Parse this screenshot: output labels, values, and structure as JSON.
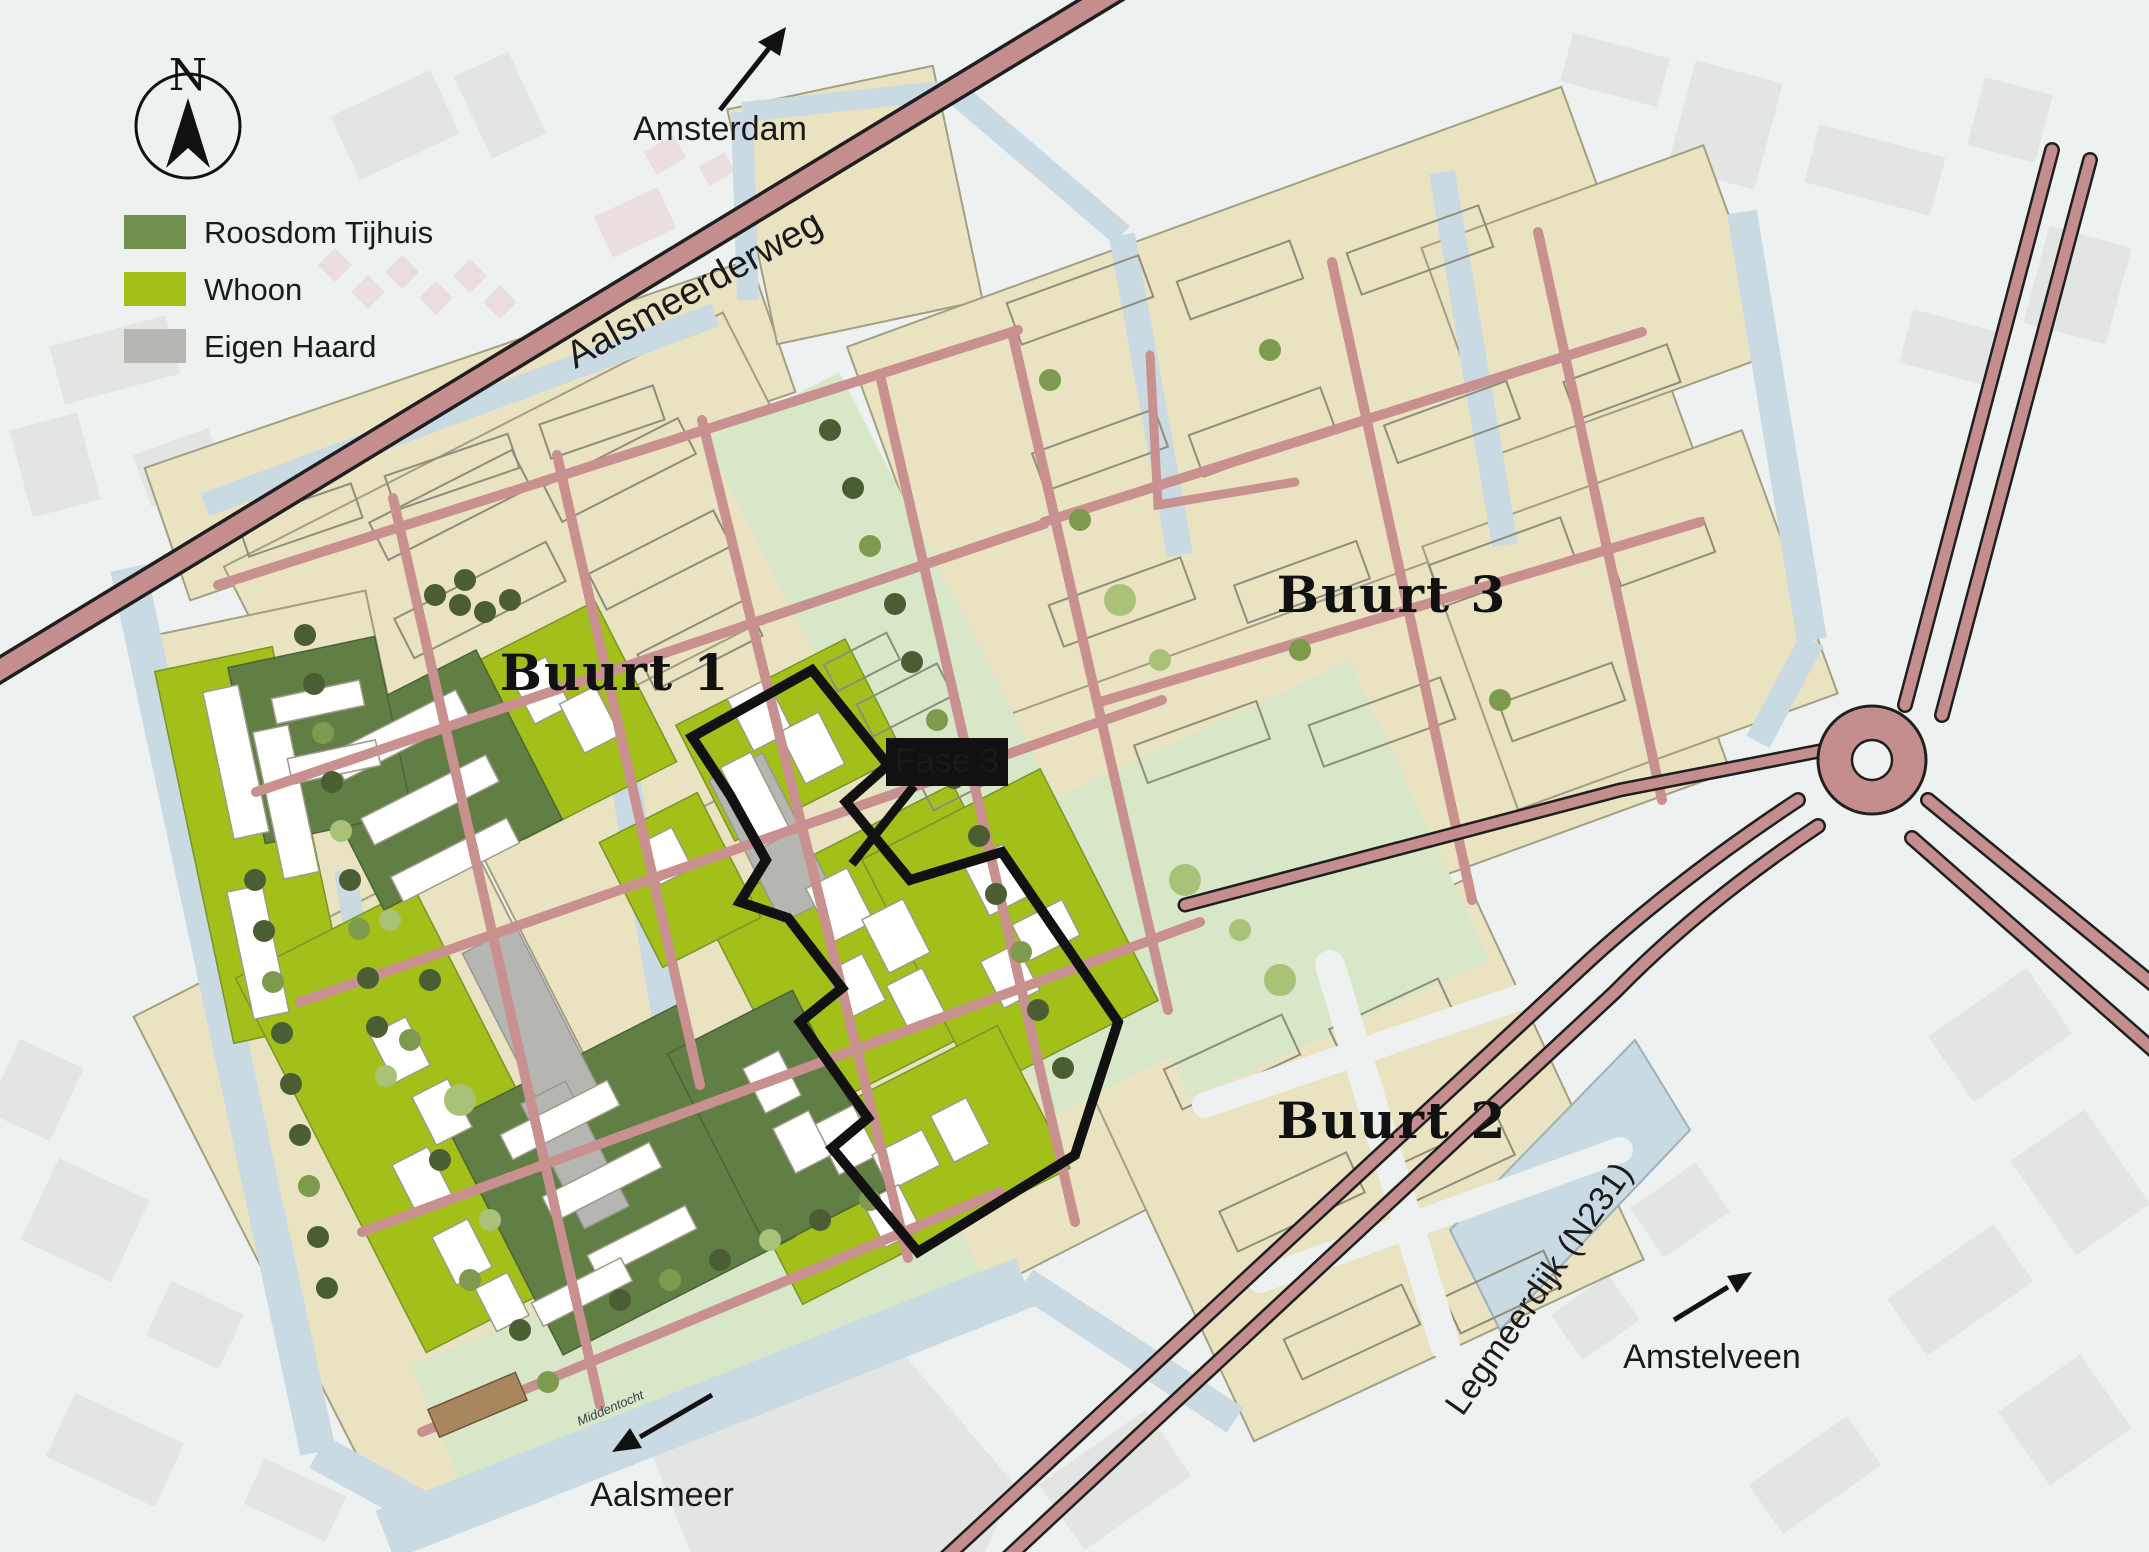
{
  "legend": {
    "items": [
      {
        "id": "roosdom",
        "label": "Roosdom Tijhuis",
        "color": "#70904f"
      },
      {
        "id": "whoon",
        "label": "Whoon",
        "color": "#a2c019"
      },
      {
        "id": "eigen-haard",
        "label": "Eigen Haard",
        "color": "#b5b5b2"
      }
    ]
  },
  "compass": {
    "letter": "N"
  },
  "labels": {
    "amsterdam": "Amsterdam",
    "aalsmeer": "Aalsmeer",
    "amstelveen": "Amstelveen",
    "aalsmeerderweg": "Aalsmeerderweg",
    "legmeerdijk": "Legmeerdijk (N231)",
    "buurt1": "Buurt 1",
    "buurt2": "Buurt 2",
    "buurt3": "Buurt 3",
    "fase3": "Fase 3",
    "middentocht": "Middentocht"
  },
  "areas": [
    {
      "name": "Buurt 1"
    },
    {
      "name": "Buurt 2"
    },
    {
      "name": "Buurt 3"
    },
    {
      "name": "Fase 3"
    }
  ],
  "roads": [
    {
      "name": "Aalsmeerderweg"
    },
    {
      "name": "Legmeerdijk (N231)"
    }
  ],
  "waterways": [
    {
      "name": "Middentocht"
    }
  ],
  "direction_arrows": [
    {
      "label": "Amsterdam",
      "direction": "north-east"
    },
    {
      "label": "Aalsmeer",
      "direction": "south-west"
    },
    {
      "label": "Amstelveen",
      "direction": "north-east"
    }
  ],
  "colors": {
    "background": "#edf1ef",
    "water": "#c9dae3",
    "site_beige": "#eae3c1",
    "lawn_green": "#d7e7c8",
    "road_pink": "#c99090",
    "roosdom_green": "#70904f",
    "whoon_green": "#a2c019",
    "eigen_haard_gray": "#b5b5b2",
    "phase_boundary": "#111111",
    "context_building": "#e3e5e3"
  }
}
